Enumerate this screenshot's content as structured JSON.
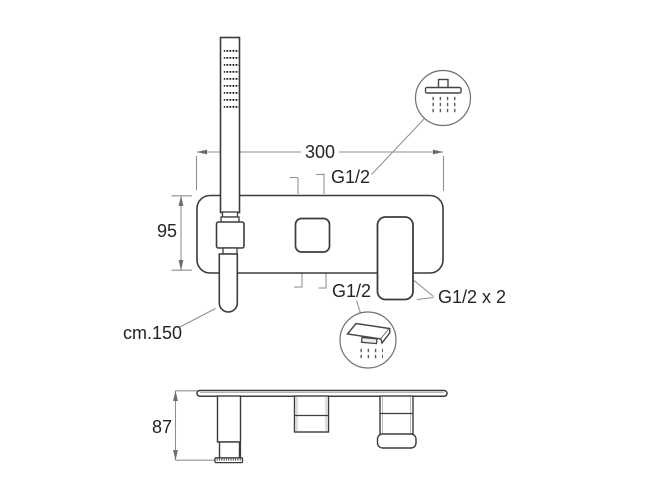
{
  "drawing": {
    "type": "technical-dimension-diagram",
    "subject": "wall-mounted shower mixer with handshower, front view and top view"
  },
  "labels": {
    "width": "300",
    "height": "95",
    "depth": "87",
    "inlet_top": "G1/2",
    "inlet_bottom": "G1/2",
    "outlets": "G1/2 x 2",
    "hose_length": "cm.150"
  },
  "icons": {
    "top_right": "overhead-shower-icon",
    "bottom_center": "spout-spray-icon"
  },
  "colors": {
    "outline": "#3c3c3c",
    "dimension_lines": "#8f8f8f",
    "arrowheads": "#6e6e6e",
    "text": "#242424",
    "background": "#ffffff"
  }
}
